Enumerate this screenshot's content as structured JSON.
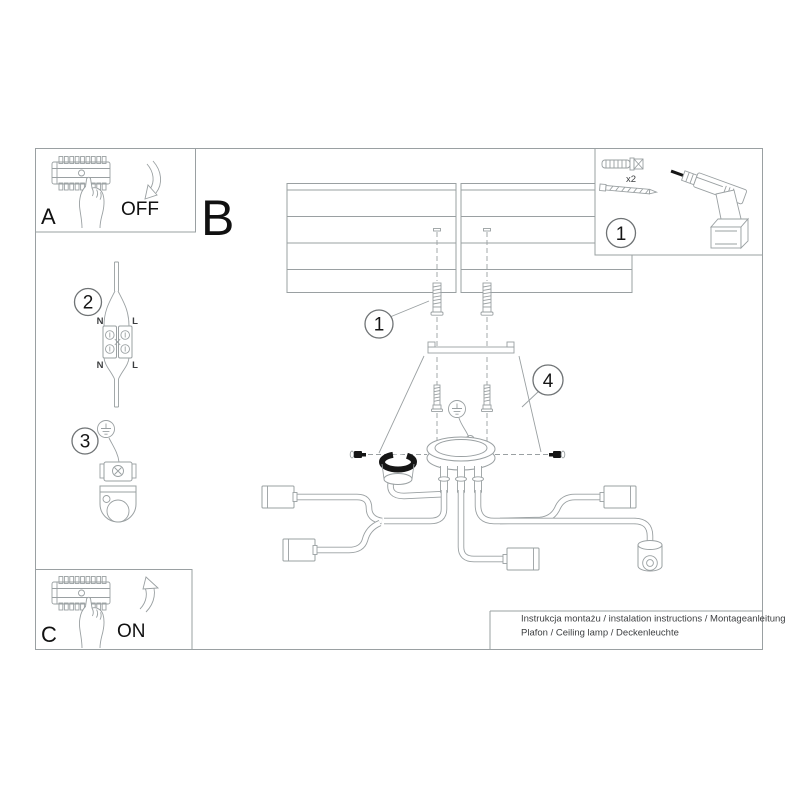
{
  "steps": {
    "a": "A",
    "b": "B",
    "c": "C",
    "off": "OFF",
    "on": "ON"
  },
  "callouts": {
    "c1_parts": "1",
    "c1_screws": "1",
    "c2": "2",
    "c3": "3",
    "c4": "4"
  },
  "wiring": {
    "n_top": "N",
    "l_top": "L",
    "n_bot": "N",
    "l_bot": "L"
  },
  "parts": {
    "anchor_qty": "x2"
  },
  "footer": {
    "line1": "Instrukcja montażu / instalation instructions / Montageanleitung",
    "line2": "Plafon / Ceiling lamp / Deckenleuchte"
  },
  "colors": {
    "line": "#9aa0a2",
    "ink": "#1a1a1a"
  }
}
